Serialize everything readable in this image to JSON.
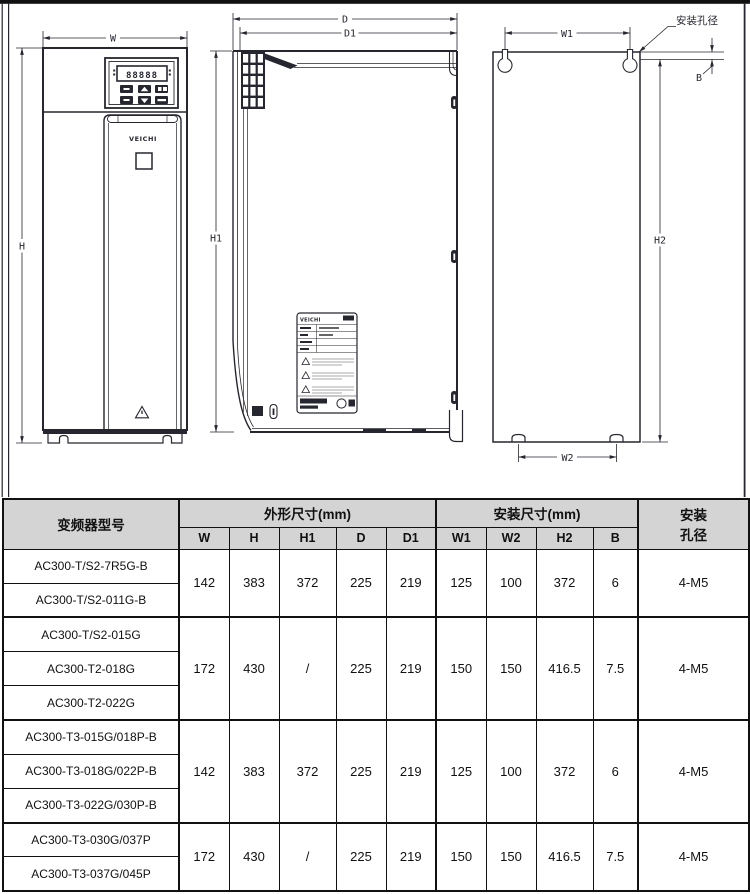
{
  "drawing": {
    "line_color": "#262630",
    "frame_color": "#111111",
    "labels": {
      "W": "W",
      "H": "H",
      "H1": "H1",
      "D": "D",
      "D1": "D1",
      "W1": "W1",
      "W2": "W2",
      "H2": "H2",
      "B": "B"
    },
    "hole_note": "安装孔径",
    "brand": "VEICHI",
    "nameplate_brand": "VEICHI",
    "display_value": "88888"
  },
  "table": {
    "header_bg": "#d4d4d4",
    "header": {
      "model": "变频器型号",
      "outline_group": "外形尺寸(mm)",
      "mount_group": "安装尺寸(mm)",
      "hole_line1": "安装",
      "hole_line2": "孔径",
      "cols": [
        "W",
        "H",
        "H1",
        "D",
        "D1",
        "W1",
        "W2",
        "H2",
        "B"
      ]
    },
    "groups": [
      {
        "models": [
          "AC300-T/S2-7R5G-B",
          "AC300-T/S2-011G-B"
        ],
        "values": {
          "W": "142",
          "H": "383",
          "H1": "372",
          "D": "225",
          "D1": "219",
          "W1": "125",
          "W2": "100",
          "H2": "372",
          "B": "6",
          "hole": "4-M5"
        }
      },
      {
        "models": [
          "AC300-T/S2-015G",
          "AC300-T2-018G",
          "AC300-T2-022G"
        ],
        "values": {
          "W": "172",
          "H": "430",
          "H1": "/",
          "D": "225",
          "D1": "219",
          "W1": "150",
          "W2": "150",
          "H2": "416.5",
          "B": "7.5",
          "hole": "4-M5"
        }
      },
      {
        "models": [
          "AC300-T3-015G/018P-B",
          "AC300-T3-018G/022P-B",
          "AC300-T3-022G/030P-B"
        ],
        "values": {
          "W": "142",
          "H": "383",
          "H1": "372",
          "D": "225",
          "D1": "219",
          "W1": "125",
          "W2": "100",
          "H2": "372",
          "B": "6",
          "hole": "4-M5"
        }
      },
      {
        "models": [
          "AC300-T3-030G/037P",
          "AC300-T3-037G/045P"
        ],
        "values": {
          "W": "172",
          "H": "430",
          "H1": "/",
          "D": "225",
          "D1": "219",
          "W1": "150",
          "W2": "150",
          "H2": "416.5",
          "B": "7.5",
          "hole": "4-M5"
        }
      }
    ]
  }
}
